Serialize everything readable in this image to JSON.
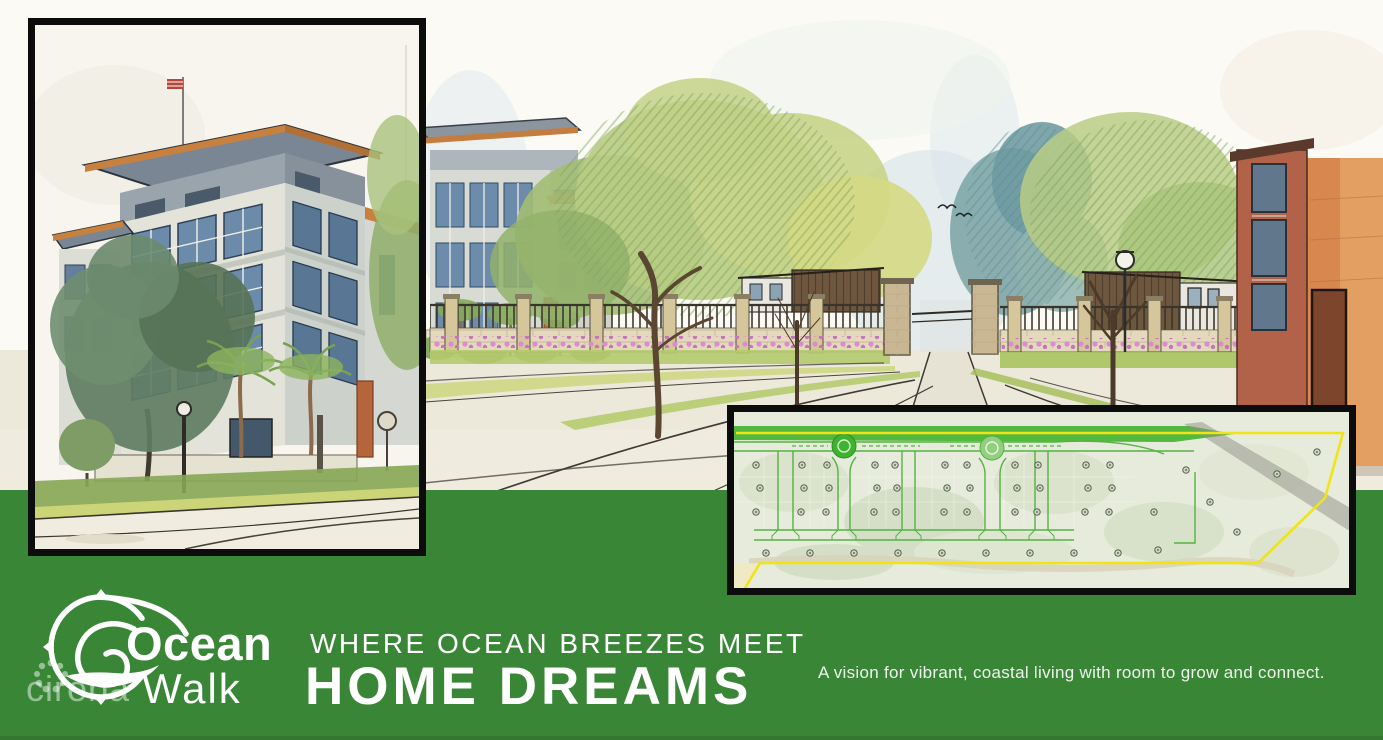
{
  "banner": {
    "brand_word1": "Ocean",
    "brand_word2": "Walk",
    "headline_small": "WHERE OCEAN BREEZES MEET",
    "headline_large": "HOME DREAMS",
    "tagline": "A vision for vibrant, coastal living with room to grow and connect.",
    "watermark": "cireba"
  },
  "icons": {
    "logo": "compass-wave-icon",
    "watermark_flower": "flower-dots-icon",
    "birds": "birds-icon"
  },
  "colors": {
    "banner_green": "#3a8637",
    "banner_green_dark": "#2f6e2c",
    "frame_black": "#0c0c0c",
    "paper_white": "#fbf9f2",
    "text_white": "#ffffff",
    "watermark_white": "rgba(255,255,255,0.48)",
    "plan_boundary_yellow": "#f0e417",
    "plan_road_green": "#55b243",
    "roof_fascia_orange": "#c8803f",
    "window_blue": "#6c8aa9",
    "right_building_orange": "#d8884f"
  }
}
